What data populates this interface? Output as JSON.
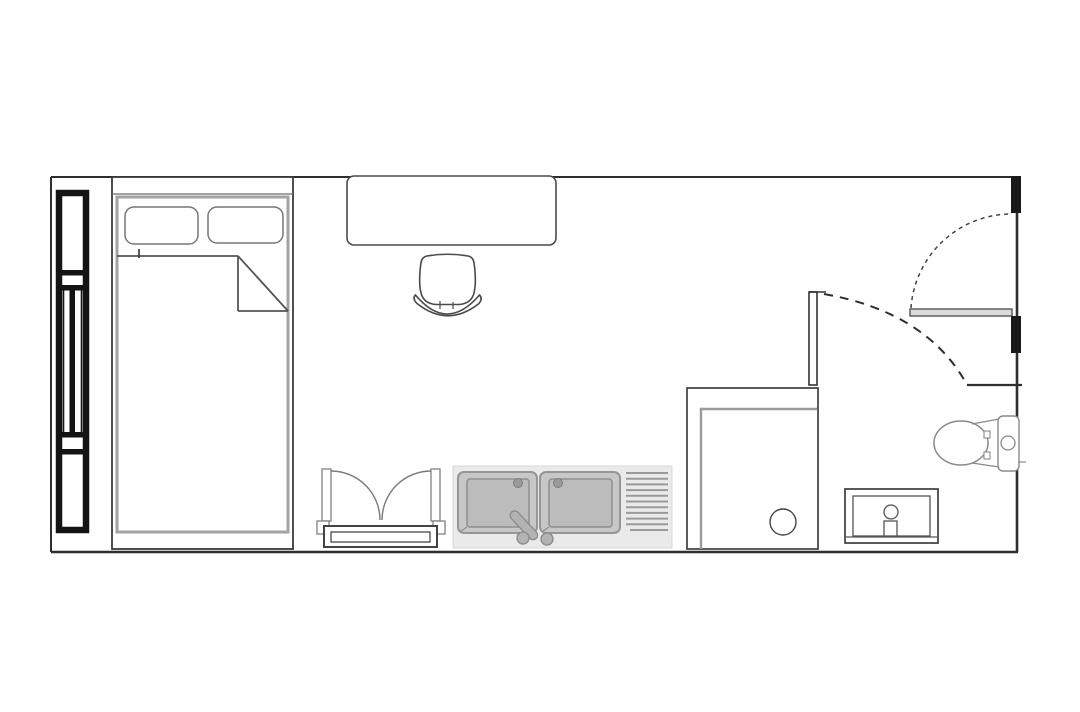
{
  "page": {
    "title": "studio-room-floor-plan",
    "type": "architectural floor plan, top view, no text labels"
  },
  "colors": {
    "background": "#ffffff",
    "wall_line": "#2e2e2e",
    "fixture_line": "#4a4a4a",
    "soft_gray_line": "#9a9a9a",
    "window_frame_black": "#141414",
    "counter_fill": "#eaeaea",
    "basin_fill": "#c7c7c7",
    "basin_inner_fill": "#bcbcbc",
    "hardware_fill": "#b3b3b3",
    "door_leaf_fill": "#dcdcdc",
    "door_jamb_fill": "#1a1a1a"
  },
  "fixtures": {
    "room": {
      "label": "Single rectangular room outline"
    },
    "window_left": {
      "label": "Tall window with black frame and mullions on left wall"
    },
    "bed": {
      "label": "Single bed with two pillows and folded-back duvet corner",
      "pillow_count": 2
    },
    "desk": {
      "label": "Desk against top wall"
    },
    "chair": {
      "label": "Desk chair with curved backrest"
    },
    "casement_window": {
      "label": "Double casement window with sill bench, bottom wall",
      "sash_count": 2
    },
    "kitchen_sink": {
      "label": "Double-basin kitchen sink unit with faucet, two knobs and drainboard",
      "basin_count": 2,
      "drainboard_line_count": 11
    },
    "shower": {
      "label": "Walk-in shower enclosure with floor drain"
    },
    "partition_wall": {
      "label": "Partition wall between room and bathroom"
    },
    "bathroom_door_swing": {
      "label": "Bathroom door swing arc (dashed)"
    },
    "entry_door": {
      "label": "Entry door leaf open against hall wall with swing arc (dashed)"
    },
    "door_jambs": {
      "label": "Black wall jamb blocks at entry opening",
      "count": 2
    },
    "toilet": {
      "label": "Toilet with tank against right wall"
    },
    "vanity": {
      "label": "Bathroom vanity sink with faucet"
    }
  }
}
